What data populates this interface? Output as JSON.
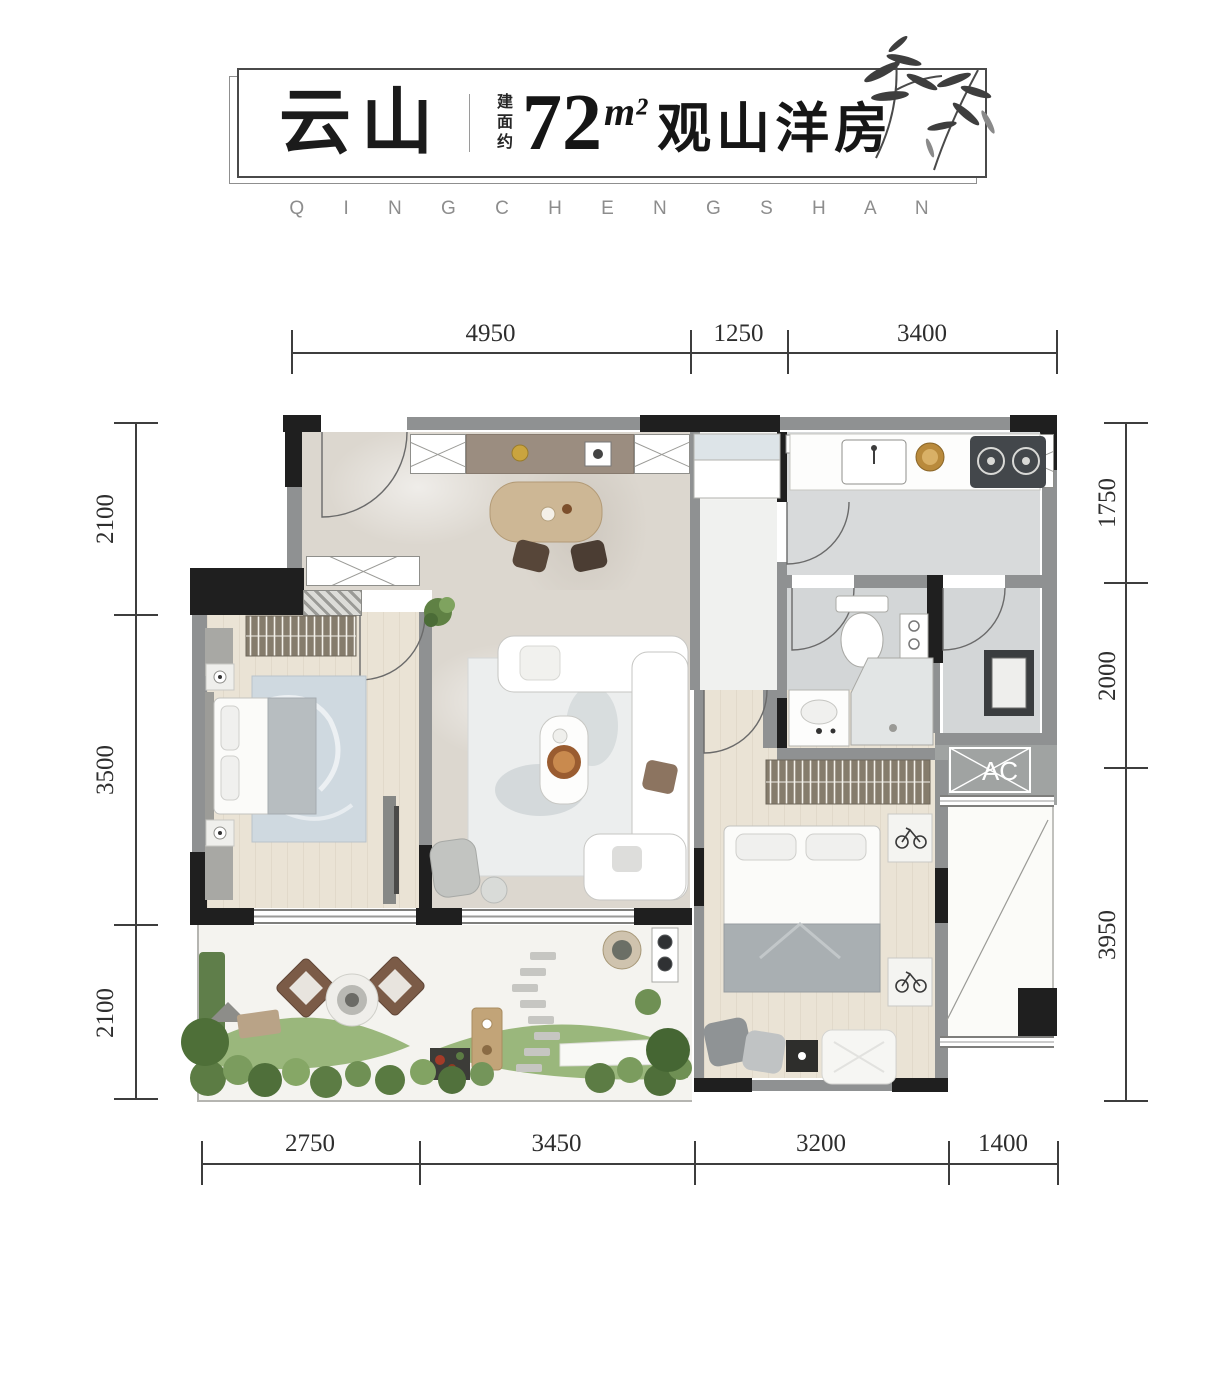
{
  "header": {
    "logo": "云山",
    "area_label_vertical": "建面约",
    "area_value": "72",
    "area_unit": "m²",
    "title": "观山洋房",
    "subtitle": "Q I N G C H E N G S H A N"
  },
  "plan": {
    "ac_label": "AC",
    "dimensions": {
      "top": [
        "4950",
        "1250",
        "3400"
      ],
      "left": [
        "2100",
        "3500",
        "2100"
      ],
      "right": [
        "1750",
        "2000",
        "3950"
      ],
      "bottom": [
        "2750",
        "3450",
        "3200",
        "1400"
      ]
    },
    "total_width_mm": 9600,
    "total_height_mm": 7700
  },
  "colors": {
    "wall_black": "#1f1f1f",
    "wall_gray": "#8f9192",
    "marble_floor": "#dcd7cf",
    "wood_floor": "#eae3d5",
    "tile_floor": "#d8dadb",
    "garden_green": "#6f9054",
    "furniture_wood": "#cdb795",
    "ink": "#1b1b1b",
    "dim_text": "#2e2e2e",
    "subtitle_gray": "#8d8d8d",
    "ac_text": "#ffffff"
  }
}
